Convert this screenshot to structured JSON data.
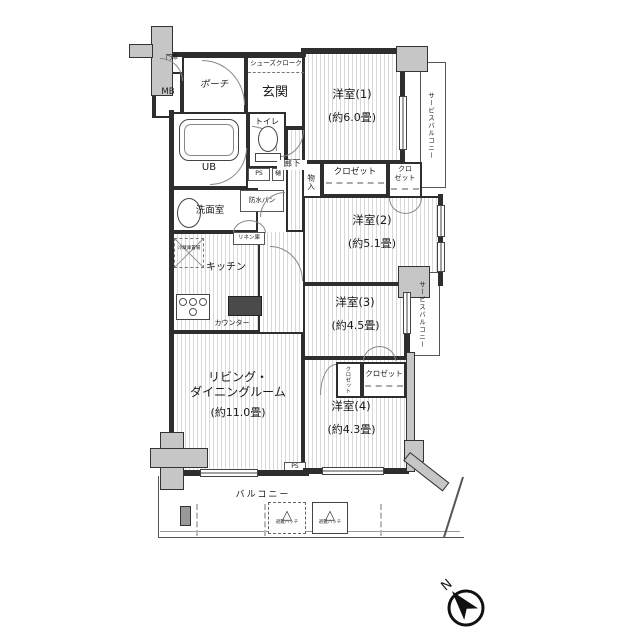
{
  "floorplan": {
    "entry": {
      "gate": "門扉",
      "mb": "MB",
      "porch": "ポーチ",
      "genkan": "玄関",
      "shoe_cloak": "シューズクローク"
    },
    "hall": {
      "corridor": "廊下",
      "storage": "物入"
    },
    "sanitary": {
      "toilet": "トイレ",
      "unit_bath": "UB",
      "ps": "PS",
      "pipe": "樋",
      "waterproof_pan": "防水パン",
      "washroom": "洗面室",
      "linen": "リネン庫"
    },
    "kitchen": {
      "name": "キッチン",
      "counter": "カウンター",
      "fridge": "冷蔵庫置場"
    },
    "living": {
      "name_line1": "リビング・",
      "name_line2": "ダイニングルーム",
      "area": "(約11.0畳)"
    },
    "rooms": {
      "western1": {
        "name": "洋室(1)",
        "area": "(約6.0畳)"
      },
      "western2": {
        "name": "洋室(2)",
        "area": "(約5.1畳)"
      },
      "western3": {
        "name": "洋室(3)",
        "area": "(約4.5畳)"
      },
      "western4": {
        "name": "洋室(4)",
        "area": "(約4.3畳)"
      }
    },
    "storage": {
      "closet": "クロゼット",
      "closet_small_line1": "クロ",
      "closet_small_line2": "ゼット"
    },
    "outdoor": {
      "service_balcony": "サービスバルコニー",
      "balcony": "バルコニー",
      "escape_hatch": "避難ハッチ"
    },
    "compass": {
      "north": "N"
    },
    "icons": {
      "escape_hatch_triangle": "△"
    }
  }
}
